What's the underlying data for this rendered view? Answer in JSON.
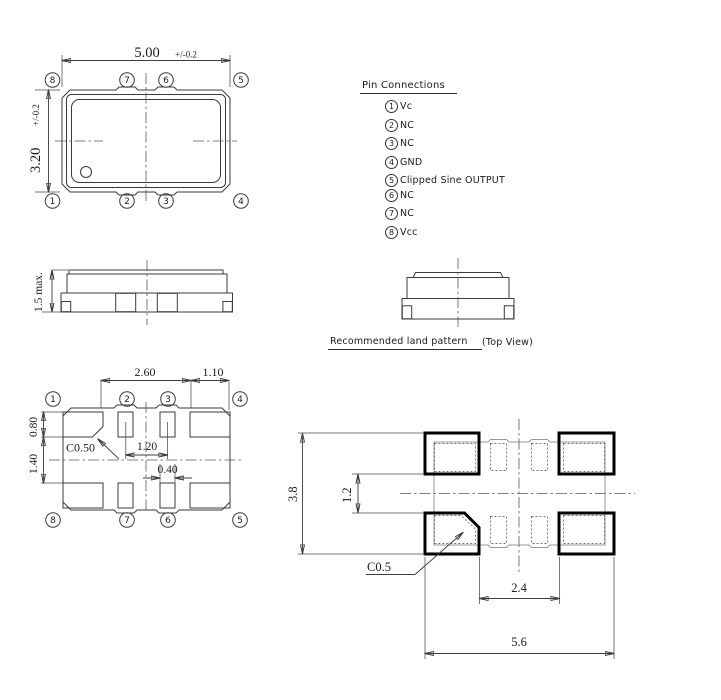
{
  "top_view": {
    "dim_width": "5.00",
    "dim_width_tol": "+/-0.2",
    "dim_height": "3.20",
    "dim_height_tol": "+/-0.2",
    "pins_top": [
      "8",
      "7",
      "6",
      "5"
    ],
    "pins_bottom": [
      "1",
      "2",
      "3",
      "4"
    ]
  },
  "pin_connections": {
    "title": "Pin Connections",
    "items": [
      {
        "num": "1",
        "label": "Vc"
      },
      {
        "num": "2",
        "label": "NC"
      },
      {
        "num": "3",
        "label": "NC"
      },
      {
        "num": "4",
        "label": "GND"
      },
      {
        "num": "5",
        "label": "Clipped Sine OUTPUT"
      },
      {
        "num": "6",
        "label": "NC"
      },
      {
        "num": "7",
        "label": "NC"
      },
      {
        "num": "8",
        "label": "Vcc"
      }
    ]
  },
  "side_view": {
    "dim_height": "1.5 max."
  },
  "land_pattern_section": {
    "title": "Recommended land pattern",
    "note": "(Top View)"
  },
  "bottom_view": {
    "pins_top": [
      "1",
      "2",
      "3",
      "4"
    ],
    "pins_bottom": [
      "8",
      "7",
      "6",
      "5"
    ],
    "dim_pad_span": "2.60",
    "dim_corner_pad_width": "1.10",
    "dim_pad_height": "0.80",
    "dim_row_gap": "1.40",
    "chamfer": "C0.50",
    "dim_center_pitch": "1.20",
    "dim_small_pad_width": "0.40"
  },
  "land_pattern": {
    "dim_overall_height": "3.8",
    "dim_row_gap": "1.2",
    "chamfer": "C0.5",
    "dim_inner_span": "2.4",
    "dim_overall_width": "5.6"
  }
}
